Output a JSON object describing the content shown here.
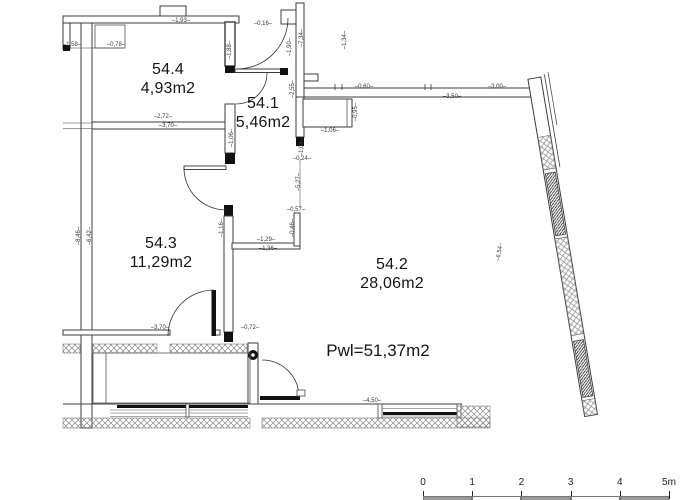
{
  "drawing": {
    "type_label": "apartment floor plan",
    "line_color": "#3c3c3c",
    "text_color": "#151515"
  },
  "rooms": [
    {
      "number": "54.4",
      "area": "4,93m2",
      "x": 168,
      "y": 70
    },
    {
      "number": "54.1",
      "area": "5,46m2",
      "x": 263,
      "y": 104
    },
    {
      "number": "54.3",
      "area": "11,29m2",
      "x": 161,
      "y": 244
    },
    {
      "number": "54.2",
      "area": "28,06m2",
      "x": 392,
      "y": 265
    }
  ],
  "total_area": {
    "text": "Pwl=51,37m2",
    "x": 378,
    "y": 351
  },
  "dimensions": [
    {
      "text": "1,93",
      "x": 181,
      "y": 21,
      "rot": 0
    },
    {
      "text": "0,16",
      "x": 263,
      "y": 24,
      "rot": 0
    },
    {
      "text": "7,34",
      "x": 302,
      "y": 38,
      "rot": -90
    },
    {
      "text": "0,78",
      "x": 116,
      "y": 45,
      "rot": 0
    },
    {
      "text": "1,58",
      "x": 72,
      "y": 45,
      "rot": 0
    },
    {
      "text": "1,88",
      "x": 230,
      "y": 50,
      "rot": -90
    },
    {
      "text": "1,90",
      "x": 290,
      "y": 47,
      "rot": -90
    },
    {
      "text": "1,34",
      "x": 345,
      "y": 40,
      "rot": -90
    },
    {
      "text": "0,60",
      "x": 364,
      "y": 87,
      "rot": 0
    },
    {
      "text": "3,00",
      "x": 497,
      "y": 87,
      "rot": 0
    },
    {
      "text": "3,50",
      "x": 452,
      "y": 97,
      "rot": 0
    },
    {
      "text": "2,55",
      "x": 293,
      "y": 89,
      "rot": -90
    },
    {
      "text": "2,72",
      "x": 163,
      "y": 117,
      "rot": 0
    },
    {
      "text": "3,70",
      "x": 168,
      "y": 126,
      "rot": 0
    },
    {
      "text": "1,06",
      "x": 330,
      "y": 131,
      "rot": 0
    },
    {
      "text": "0,95",
      "x": 356,
      "y": 112,
      "rot": -90
    },
    {
      "text": "1,06",
      "x": 232,
      "y": 138,
      "rot": -90
    },
    {
      "text": "1,04",
      "x": 302,
      "y": 147,
      "rot": -90
    },
    {
      "text": "0,24",
      "x": 302,
      "y": 159,
      "rot": 0
    },
    {
      "text": "5,27",
      "x": 299,
      "y": 182,
      "rot": -90
    },
    {
      "text": "0,57",
      "x": 296,
      "y": 210,
      "rot": 0
    },
    {
      "text": "0,46",
      "x": 293,
      "y": 228,
      "rot": -90
    },
    {
      "text": "1,16",
      "x": 222,
      "y": 228,
      "rot": -90
    },
    {
      "text": "8,46",
      "x": 79,
      "y": 236,
      "rot": -90
    },
    {
      "text": "6,42",
      "x": 90,
      "y": 236,
      "rot": -90
    },
    {
      "text": "1,29",
      "x": 266,
      "y": 240,
      "rot": 0
    },
    {
      "text": "1,36",
      "x": 268,
      "y": 249,
      "rot": 0
    },
    {
      "text": "6,54",
      "x": 500,
      "y": 252,
      "rot": -80
    },
    {
      "text": "3,70",
      "x": 160,
      "y": 328,
      "rot": 0
    },
    {
      "text": "0,72",
      "x": 250,
      "y": 328,
      "rot": 0
    },
    {
      "text": "4,50",
      "x": 372,
      "y": 401,
      "rot": 0
    }
  ],
  "scale_bar": {
    "labels": [
      "0",
      "1",
      "2",
      "3",
      "4",
      "5m"
    ],
    "x_start": 423,
    "spacing": 49.2,
    "label_y": 478,
    "tick_y": 491,
    "bar_y": 496
  }
}
